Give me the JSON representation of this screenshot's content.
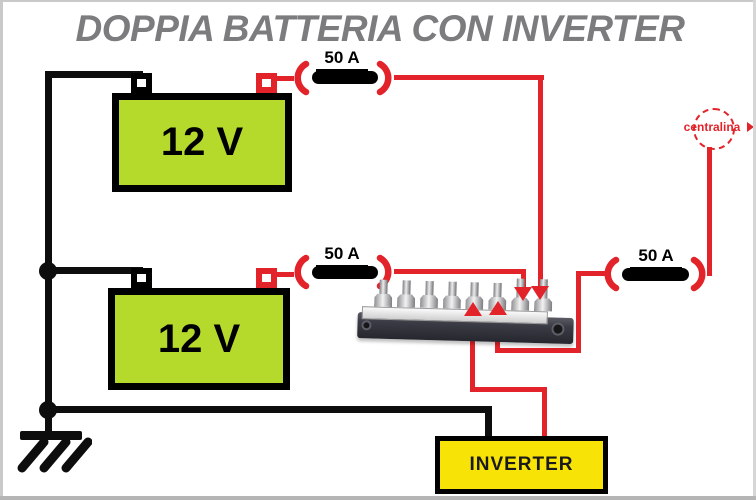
{
  "title": "DOPPIA BATTERIA CON INVERTER",
  "batteries": [
    {
      "label": "12 V"
    },
    {
      "label": "12 V"
    }
  ],
  "fuses": [
    {
      "label": "50 A"
    },
    {
      "label": "50 A"
    },
    {
      "label": "50 A"
    }
  ],
  "centralina": {
    "label": "centralina"
  },
  "inverter": {
    "label": "INVERTER"
  },
  "busbar": {
    "terminal_count": 8
  },
  "ground": {
    "symbol": "earth-ground"
  },
  "colors": {
    "wire_red": "#e2242a",
    "wire_black": "#0d0d0d",
    "battery_green": "#b5da2b",
    "inverter_yellow": "#f7e406",
    "title_gray": "#7c7c7e"
  }
}
